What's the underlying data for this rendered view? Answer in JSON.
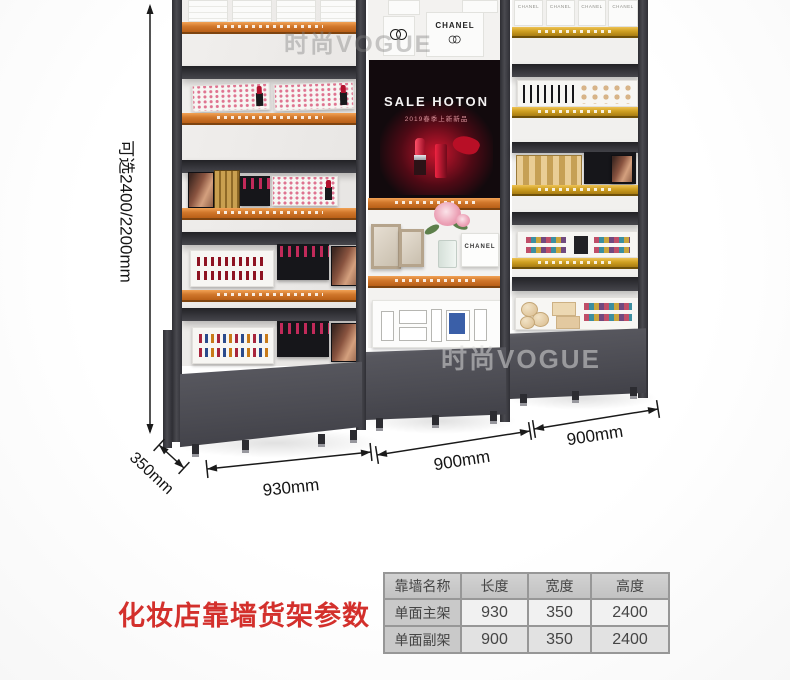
{
  "watermarks": {
    "top": "时尚VOGUE",
    "right": "时尚VOGUE"
  },
  "brand": {
    "chanel": "CHANEL"
  },
  "screen": {
    "title": "SALE HOTON",
    "subtitle": "2019春季上新新品"
  },
  "dimensions": {
    "height": "可选2400/2200mm",
    "depth": "350mm",
    "width_main": "930mm",
    "width_mid": "900mm",
    "width_right": "900mm"
  },
  "caption": "化妆店靠墙货架参数",
  "spec_table": {
    "headers": [
      "靠墙名称",
      "长度",
      "宽度",
      "高度"
    ],
    "rows": [
      {
        "name": "单面主架",
        "length": "930",
        "width": "350",
        "height": "2400"
      },
      {
        "name": "单面副架",
        "length": "900",
        "width": "350",
        "height": "2400"
      }
    ]
  }
}
